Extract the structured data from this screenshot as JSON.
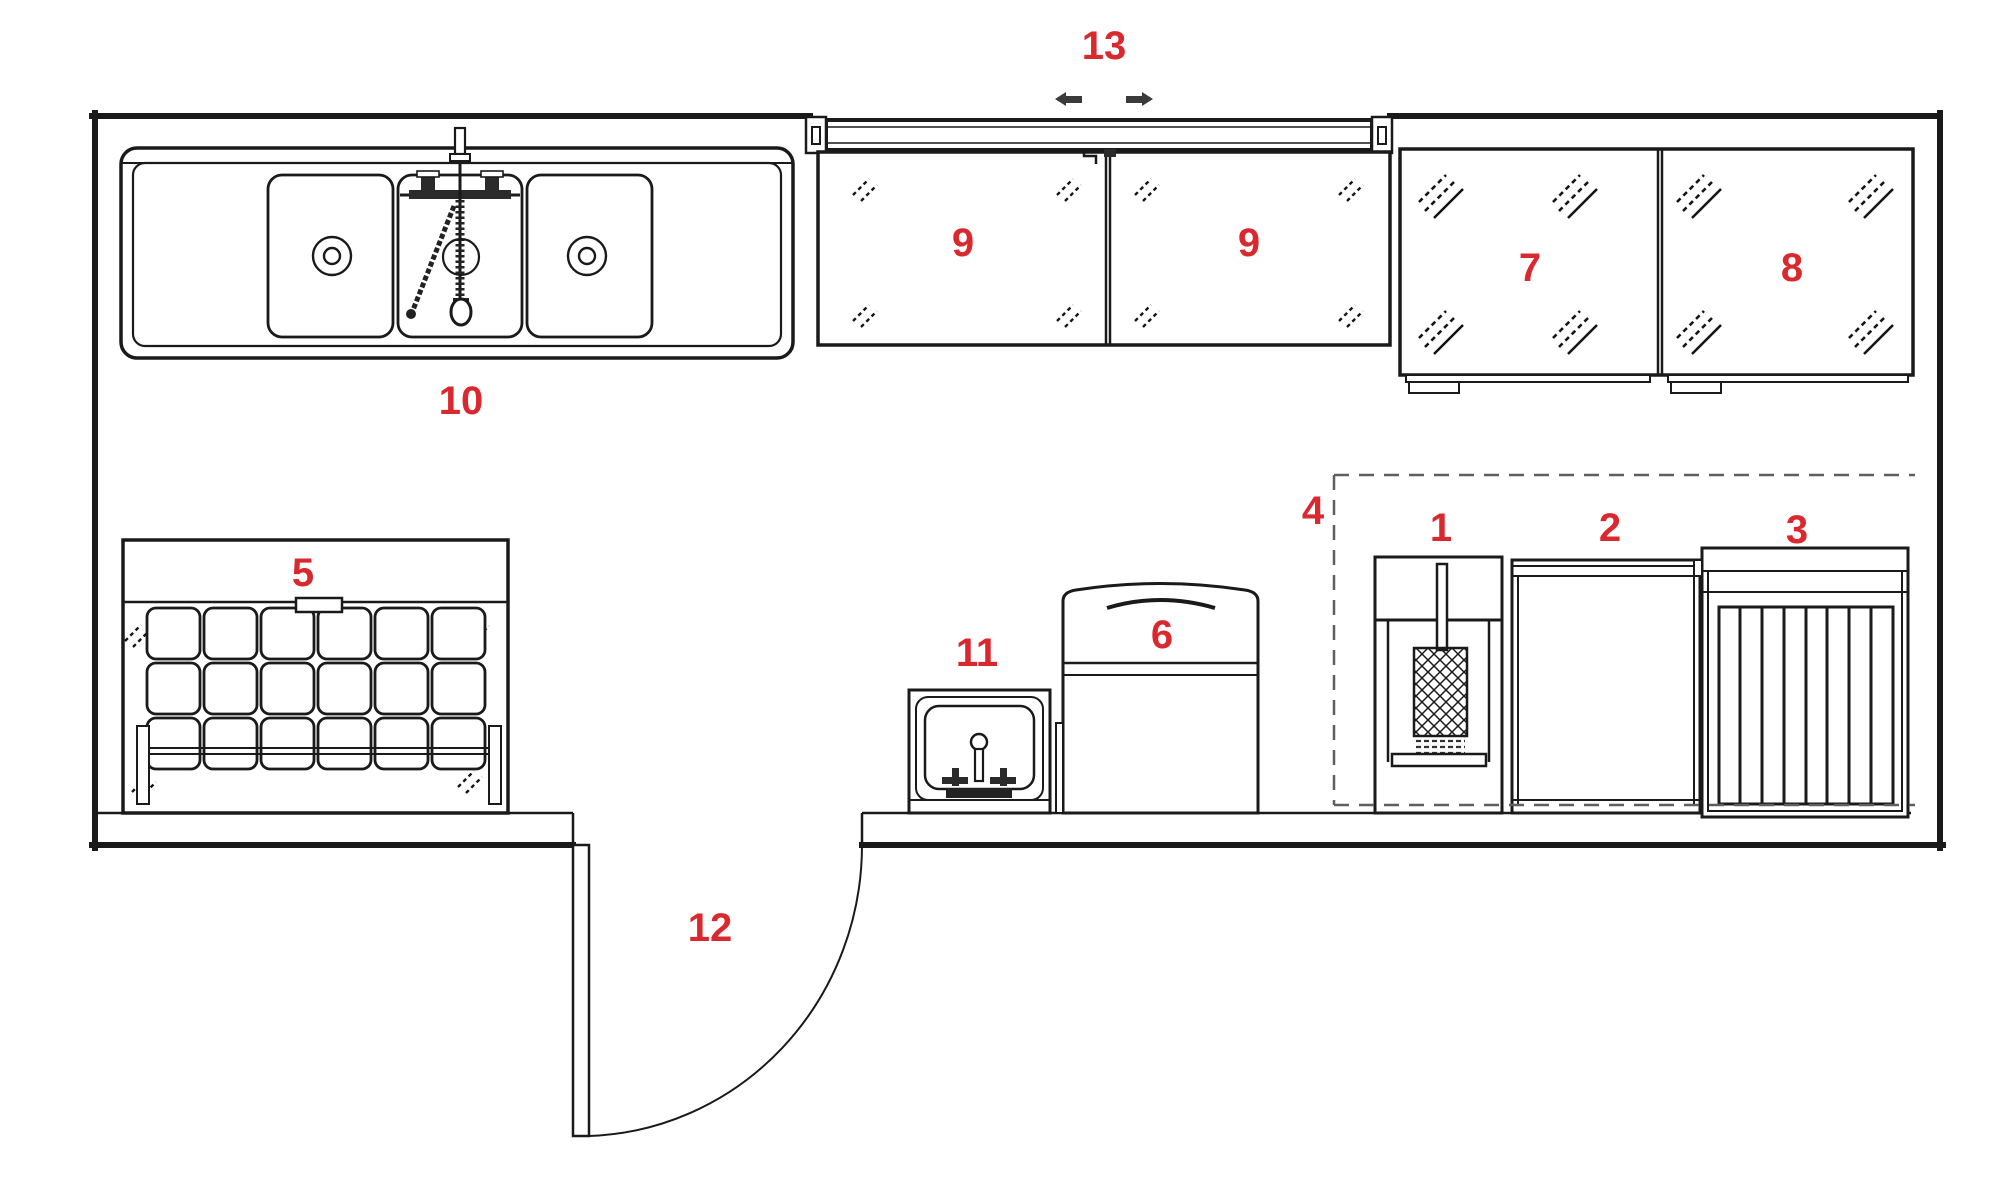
{
  "figure": {
    "type": "floor-plan"
  },
  "colors": {
    "accent": "#d9282e",
    "line": "#1a1a1a",
    "background": "#ffffff"
  },
  "labels": {
    "l1": "1",
    "l2": "2",
    "l3": "3",
    "l4": "4",
    "l5": "5",
    "l6": "6",
    "l7": "7",
    "l8": "8",
    "l9a": "9",
    "l9b": "9",
    "l10": "10",
    "l11": "11",
    "l12": "12",
    "l13": "13"
  }
}
